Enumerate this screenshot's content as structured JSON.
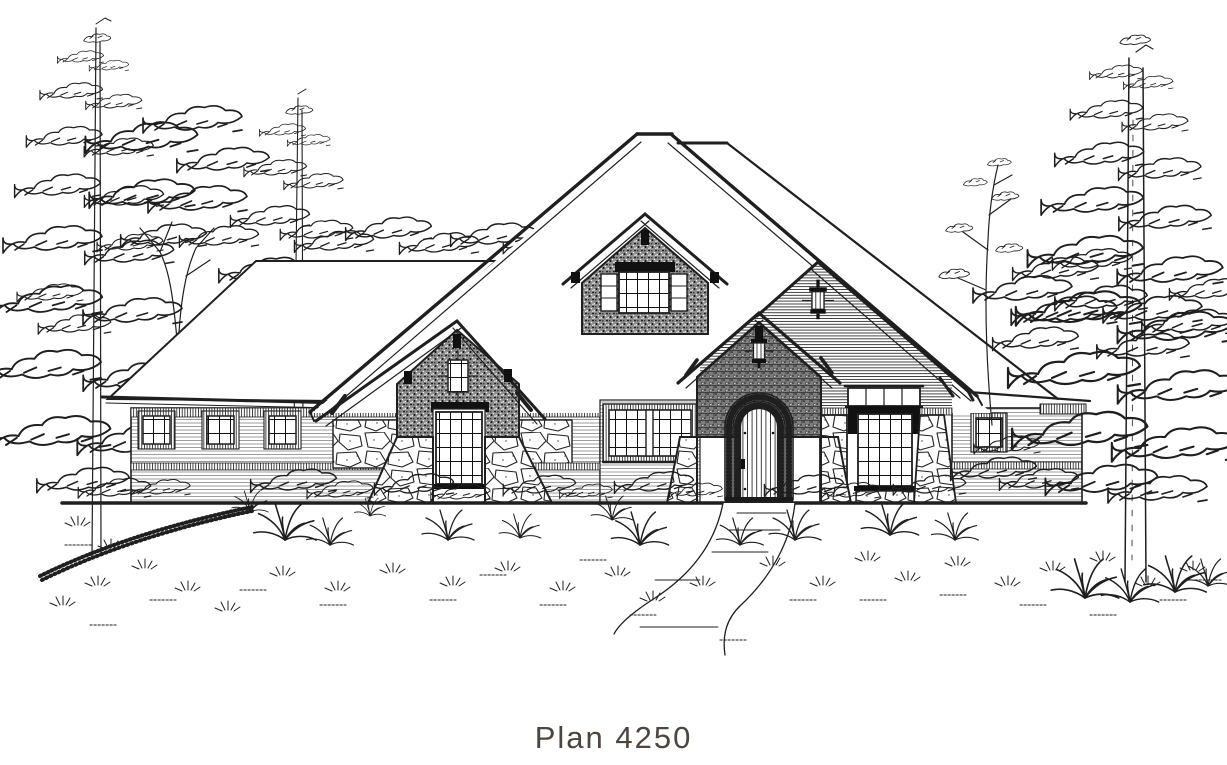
{
  "page": {
    "background_color": "#ffffff",
    "ink_color": "#1f1f1f"
  },
  "caption": {
    "text": "Plan 4250",
    "color": "#4c463e"
  },
  "drawing": {
    "kind": "architectural-front-elevation-line-drawing",
    "palette": {
      "shingle_gable_gray": "#8e8e8e",
      "brick_gable_gray": "#7e7e7e",
      "paper_white": "#ffffff"
    },
    "elements": [
      "left-pine-trees",
      "deciduous-tree",
      "left-wing",
      "left-wing-windows",
      "main-roof",
      "center-dormer",
      "dormer-window",
      "left-gable",
      "left-gable-window",
      "double-window",
      "entry-gable",
      "entry-lantern",
      "arched-front-door",
      "right-gable",
      "gable-lantern",
      "transom-window",
      "right-wing",
      "right-wing-window",
      "stone-accents",
      "ground-line",
      "front-walkway",
      "foundation-shrubs",
      "ornamental-grasses",
      "right-pine-tree",
      "plan-caption"
    ]
  }
}
